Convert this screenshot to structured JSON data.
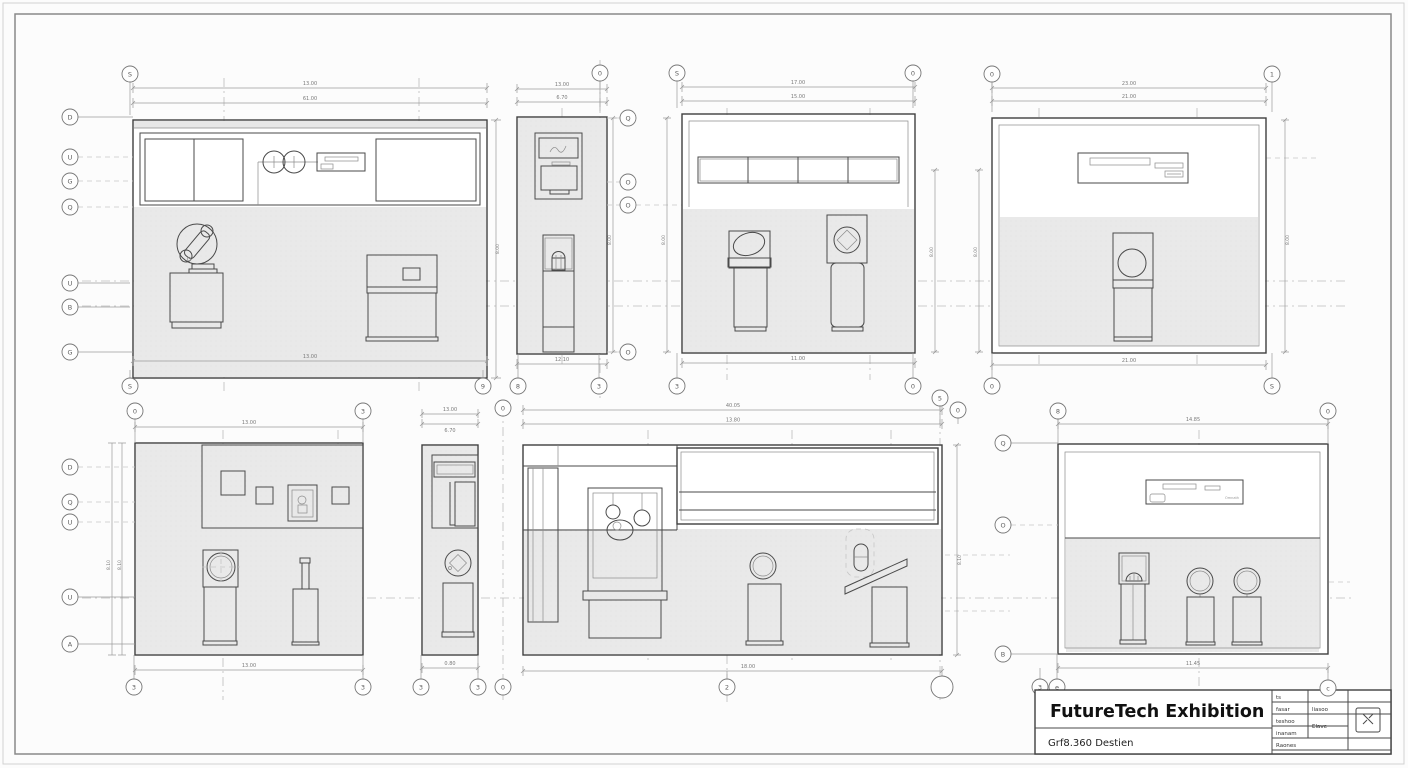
{
  "sheet": {
    "background": "#fcfcfc",
    "border_color": "#8a8a8a"
  },
  "colors": {
    "wall_fill": "#e9e9e9",
    "line_color": "#4a4a4a",
    "dimension_color": "#9a9a9a",
    "dashed_grid_color": "#bcbcbc"
  },
  "title_block": {
    "project_title": "FutureTech Exhibition",
    "project_subtitle": "Grf8.360 Destien",
    "table": {
      "r1c1": "ts",
      "r2c1": "fasar",
      "r2c2": "liasoo",
      "r3c1": "teshoo",
      "r3c2": "Elave",
      "r4c1": "inanam",
      "r5c1": "Raones"
    },
    "revision_bubble": "c"
  },
  "grid_bubbles": {
    "row_top": [
      "S",
      "0",
      "S",
      "0",
      "0",
      "1"
    ],
    "row_mid": [
      "S",
      "9",
      "8",
      "3",
      "3",
      "0",
      "0",
      "S"
    ],
    "col_a_left": [
      "D",
      "U",
      "G",
      "Q",
      "U",
      "B",
      "G"
    ],
    "col_b_right": [
      "Q",
      "O",
      "O",
      "O"
    ],
    "row_lower_top": [
      "0",
      "3",
      "0",
      "5",
      "0",
      "8",
      "0"
    ],
    "col_e_left": [
      "D",
      "Q",
      "U",
      "U",
      "A"
    ],
    "col_h_left": [
      "Q",
      "O",
      "B"
    ],
    "row_bottom": [
      "3",
      "3",
      "3",
      "3",
      "0",
      "2",
      "",
      "3",
      "e"
    ]
  },
  "elevations": {
    "a": {
      "dims": {
        "top1": "13.00",
        "top2": "61.00",
        "bottom": "13.00",
        "right": "8.00"
      }
    },
    "b": {
      "dims": {
        "top1": "13.00",
        "top2": "6.70",
        "bottom": "12.10",
        "v1": "8.00",
        "v2": "8.00"
      }
    },
    "c": {
      "dims": {
        "top1": "17.00",
        "top2": "15.00",
        "bottom": "11.00"
      }
    },
    "d": {
      "dims": {
        "top1": "23.00",
        "top2": "21.00",
        "bottom": "21.00",
        "vleft1": "8.00",
        "vleft2": "8.00",
        "right": "8.00"
      }
    },
    "e": {
      "dims": {
        "top": "13.00",
        "bottom": "13.00",
        "v1": "8.10",
        "v2": "8.10"
      }
    },
    "f": {
      "dims": {
        "top1": "13.00",
        "top2": "6.70",
        "bottom": "0.80"
      }
    },
    "g": {
      "dims": {
        "top1": "40.05",
        "top2": "13.80",
        "bottom": "18.00",
        "right": "8.10"
      }
    },
    "h": {
      "dims": {
        "top": "14.85",
        "bottom": "11.45"
      },
      "sign_text": "Omnath"
    }
  }
}
